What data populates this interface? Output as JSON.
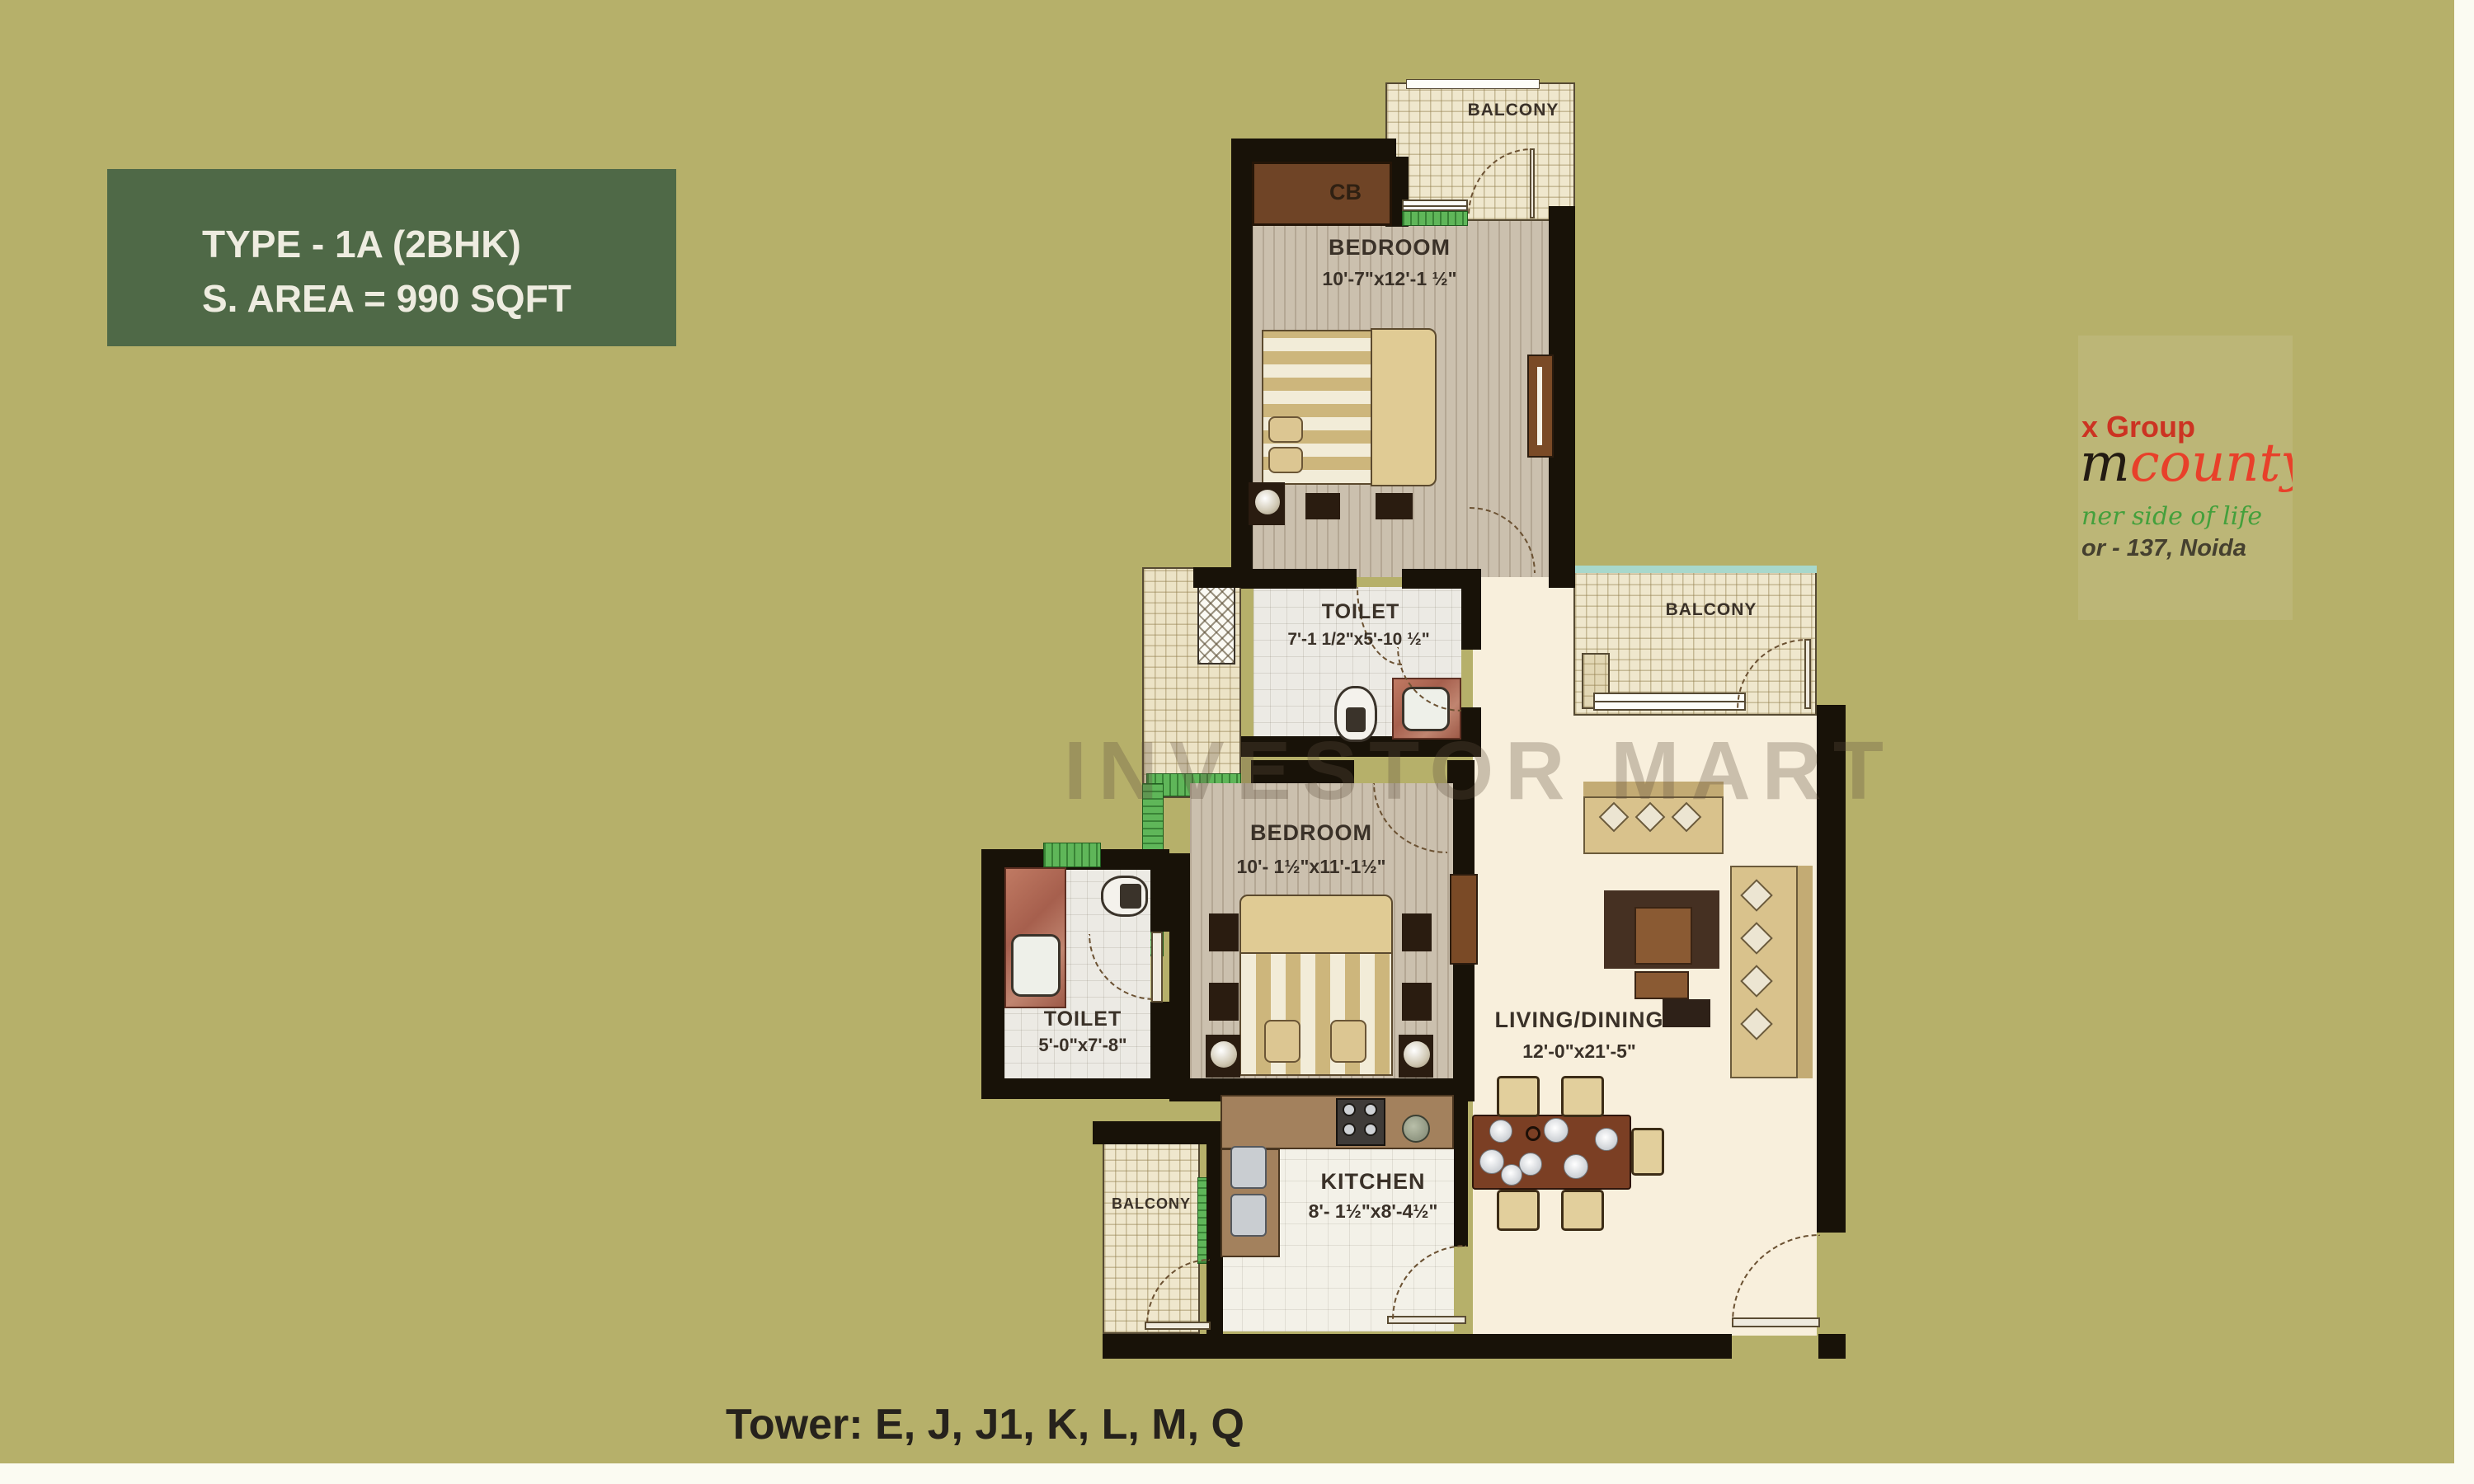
{
  "title_box": {
    "line1": "TYPE - 1A (2BHK)",
    "line2": "S. AREA = 990 SQFT"
  },
  "footer": {
    "towers": "Tower: E, J, J1, K, L, M, Q"
  },
  "watermark": "INVESTOR MART",
  "logo": {
    "group": "x Group",
    "brand_prefix": "m",
    "brand": "county",
    "tagline": "ner side of life",
    "address": "or - 137, Noida"
  },
  "rooms": {
    "bedroom_top": {
      "name": "BEDROOM",
      "dim": "10'-7\"x12'-1 ½\""
    },
    "toilet_top": {
      "name": "TOILET",
      "dim": "7'-1 1/2\"x5'-10 ½\""
    },
    "balcony_top": {
      "name": "BALCONY"
    },
    "balcony_right": {
      "name": "BALCONY"
    },
    "bedroom_mid": {
      "name": "BEDROOM",
      "dim": "10'- 1½\"x11'-1½\""
    },
    "toilet_left": {
      "name": "TOILET",
      "dim": "5'-0\"x7'-8\""
    },
    "kitchen": {
      "name": "KITCHEN",
      "dim": "8'- 1½\"x8'-4½\""
    },
    "living": {
      "name": "LIVING/DINING",
      "dim": "12'-0\"x21'-5\""
    },
    "balcony_bottom": {
      "name": "BALCONY"
    },
    "closet": {
      "label": "CB"
    }
  },
  "colors": {
    "background": "#b6b06a",
    "title_box_bg": "#4f6947",
    "wall": "#181208",
    "living_floor": "#f8efdc",
    "wood_floor": "#cbc0ae",
    "balcony_hatch": "#efe7cd",
    "counter_brown": "#a3815d",
    "logo_red": "#e8402a",
    "logo_green": "#44a03c"
  }
}
